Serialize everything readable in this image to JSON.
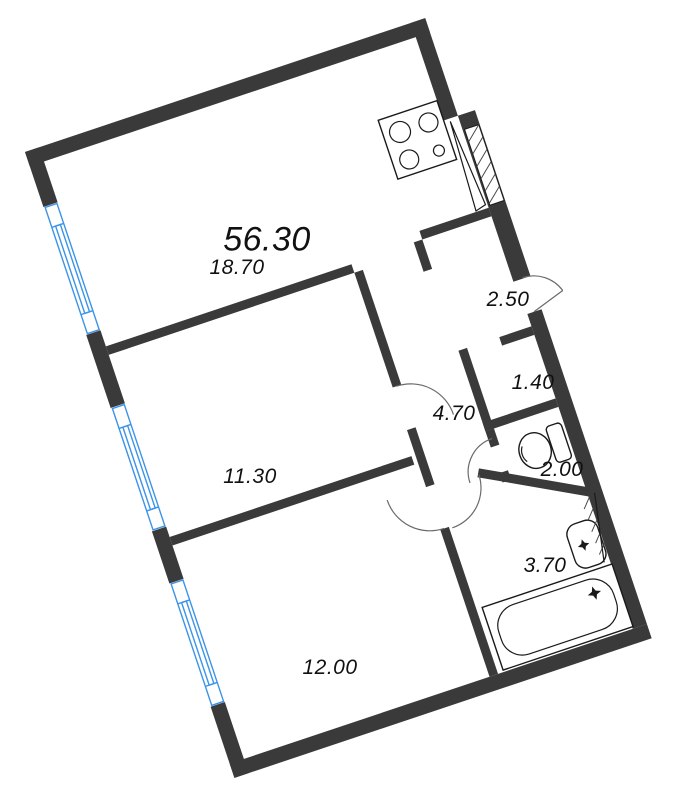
{
  "title": "apartment-floor-plan",
  "labels": [
    {
      "name": "total-area",
      "text": "56.30"
    },
    {
      "name": "living-kitchen-area",
      "text": "18.70"
    },
    {
      "name": "bedroom-1-area",
      "text": "11.30"
    },
    {
      "name": "bedroom-2-area",
      "text": "12.00"
    },
    {
      "name": "entry-hall-area",
      "text": "2.50"
    },
    {
      "name": "corridor-area",
      "text": "4.70"
    },
    {
      "name": "closet-area",
      "text": "1.40"
    },
    {
      "name": "wc-area",
      "text": "2.00"
    },
    {
      "name": "bathroom-area",
      "text": "3.70"
    }
  ],
  "colors": {
    "wall": "#3a3a3a",
    "window": "#3b93e8",
    "line": "#1a1a1a",
    "text": "#111111",
    "background": "#ffffff"
  },
  "fixtures": [
    "stove-icon",
    "entry-door-leaf",
    "ventilation-shaft",
    "toilet-icon",
    "sink-icon",
    "bathtub-icon"
  ],
  "windows_count": 3,
  "door_arcs_count": 5,
  "rotation_degrees": -18.5
}
